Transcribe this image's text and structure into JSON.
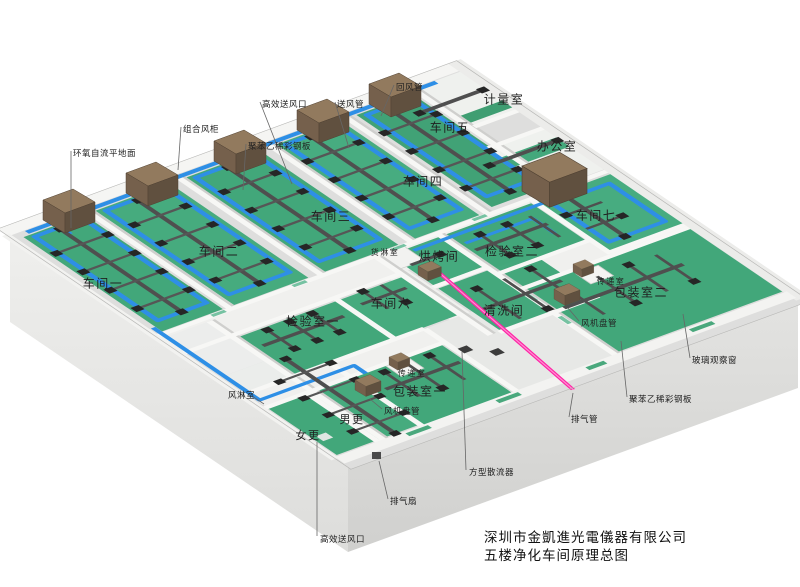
{
  "title_block": {
    "company": "深圳市金凱進光電儀器有限公司",
    "drawing_title": "五楼净化车间原理总图"
  },
  "palette": {
    "supply_duct_blue": "#2e8fe6",
    "exhaust_duct_dark": "#4f4f4f",
    "exhaust_pink": "#ff23a6",
    "floor_green": "#42a77a",
    "ahu_brown": "#927a5e",
    "slab_gray": "#dededd"
  },
  "room_labels": [
    {
      "id": "cj1",
      "text": "车间一",
      "x": 103,
      "y": 284,
      "size": 12
    },
    {
      "id": "cj2",
      "text": "车间二",
      "x": 219,
      "y": 252,
      "size": 12
    },
    {
      "id": "cj3",
      "text": "车间三",
      "x": 331,
      "y": 217,
      "size": 12
    },
    {
      "id": "cj4",
      "text": "车间四",
      "x": 423,
      "y": 182,
      "size": 12
    },
    {
      "id": "cj5",
      "text": "车间五",
      "x": 450,
      "y": 128,
      "size": 12
    },
    {
      "id": "cj6",
      "text": "车间六",
      "x": 391,
      "y": 304,
      "size": 12
    },
    {
      "id": "cj7",
      "text": "车间七",
      "x": 596,
      "y": 216,
      "size": 12
    },
    {
      "id": "jiliangshi",
      "text": "计量室",
      "x": 504,
      "y": 100,
      "size": 12
    },
    {
      "id": "bangongshi",
      "text": "办公室",
      "x": 557,
      "y": 147,
      "size": 12
    },
    {
      "id": "jianyanshi1",
      "text": "检验室一",
      "x": 313,
      "y": 322,
      "size": 12
    },
    {
      "id": "jianyanshi2",
      "text": "检验室二",
      "x": 512,
      "y": 252,
      "size": 12
    },
    {
      "id": "hongkaojian",
      "text": "烘烤间",
      "x": 439,
      "y": 257,
      "size": 12
    },
    {
      "id": "qingxijian",
      "text": "清洗间",
      "x": 504,
      "y": 311,
      "size": 12
    },
    {
      "id": "huolinshi",
      "text": "货淋室",
      "x": 385,
      "y": 253,
      "size": 8
    },
    {
      "id": "nangeng",
      "text": "男更",
      "x": 352,
      "y": 420,
      "size": 11
    },
    {
      "id": "nvgeng",
      "text": "女更",
      "x": 308,
      "y": 436,
      "size": 11
    },
    {
      "id": "baozhuangshi1",
      "text": "包装室一",
      "x": 420,
      "y": 392,
      "size": 12
    },
    {
      "id": "baozhuangshi2",
      "text": "包装室二",
      "x": 641,
      "y": 293,
      "size": 12
    },
    {
      "id": "chuandishi-right",
      "text": "传递室",
      "x": 611,
      "y": 282,
      "size": 8
    },
    {
      "id": "chuandishi-left",
      "text": "传递室",
      "x": 412,
      "y": 374,
      "size": 8
    }
  ],
  "callouts": [
    {
      "id": "epoxy-floor",
      "text": "环氧自流平地面",
      "x": 73,
      "y": 147,
      "pts": "71,151 71,228"
    },
    {
      "id": "ahu-cabinet",
      "text": "组合风柜",
      "x": 183,
      "y": 123,
      "pts": "181,127 178,170"
    },
    {
      "id": "steel-panel-left",
      "text": "聚苯乙稀彩钢板",
      "x": 248,
      "y": 140,
      "pts": "246,144 243,190"
    },
    {
      "id": "hepa-outlet-top",
      "text": "高效送风口",
      "x": 262,
      "y": 98,
      "pts": "260,102 292,184"
    },
    {
      "id": "supply-duct",
      "text": "送风管",
      "x": 337,
      "y": 98,
      "pts": "335,102 349,148"
    },
    {
      "id": "return-duct",
      "text": "回风管",
      "x": 396,
      "y": 81,
      "pts": "394,85 381,116"
    },
    {
      "id": "air-shower",
      "text": "风淋室",
      "x": 228,
      "y": 389,
      "pts": "252,396 264,404"
    },
    {
      "id": "fan-coil-left",
      "text": "风机盘管",
      "x": 384,
      "y": 405,
      "pts": "382,409 370,399"
    },
    {
      "id": "fan-coil-right",
      "text": "风机盘管",
      "x": 581,
      "y": 317,
      "pts": "579,321 568,308"
    },
    {
      "id": "glass-window",
      "text": "玻璃观察窗",
      "x": 692,
      "y": 354,
      "pts": "690,358 683,314"
    },
    {
      "id": "steel-panel-right",
      "text": "聚苯乙稀彩钢板",
      "x": 629,
      "y": 393,
      "pts": "627,397 621,341"
    },
    {
      "id": "exhaust-pipe",
      "text": "排气管",
      "x": 571,
      "y": 413,
      "pts": "569,417 573,393"
    },
    {
      "id": "exhaust-fan",
      "text": "排气扇",
      "x": 390,
      "y": 495,
      "pts": "388,499 379,461"
    },
    {
      "id": "square-diffuser",
      "text": "方型散流器",
      "x": 469,
      "y": 466,
      "pts": "466,470 462,352"
    },
    {
      "id": "hepa-outlet-bottom",
      "text": "高效送风口",
      "x": 320,
      "y": 533,
      "pts": "317,536 317,442"
    }
  ]
}
